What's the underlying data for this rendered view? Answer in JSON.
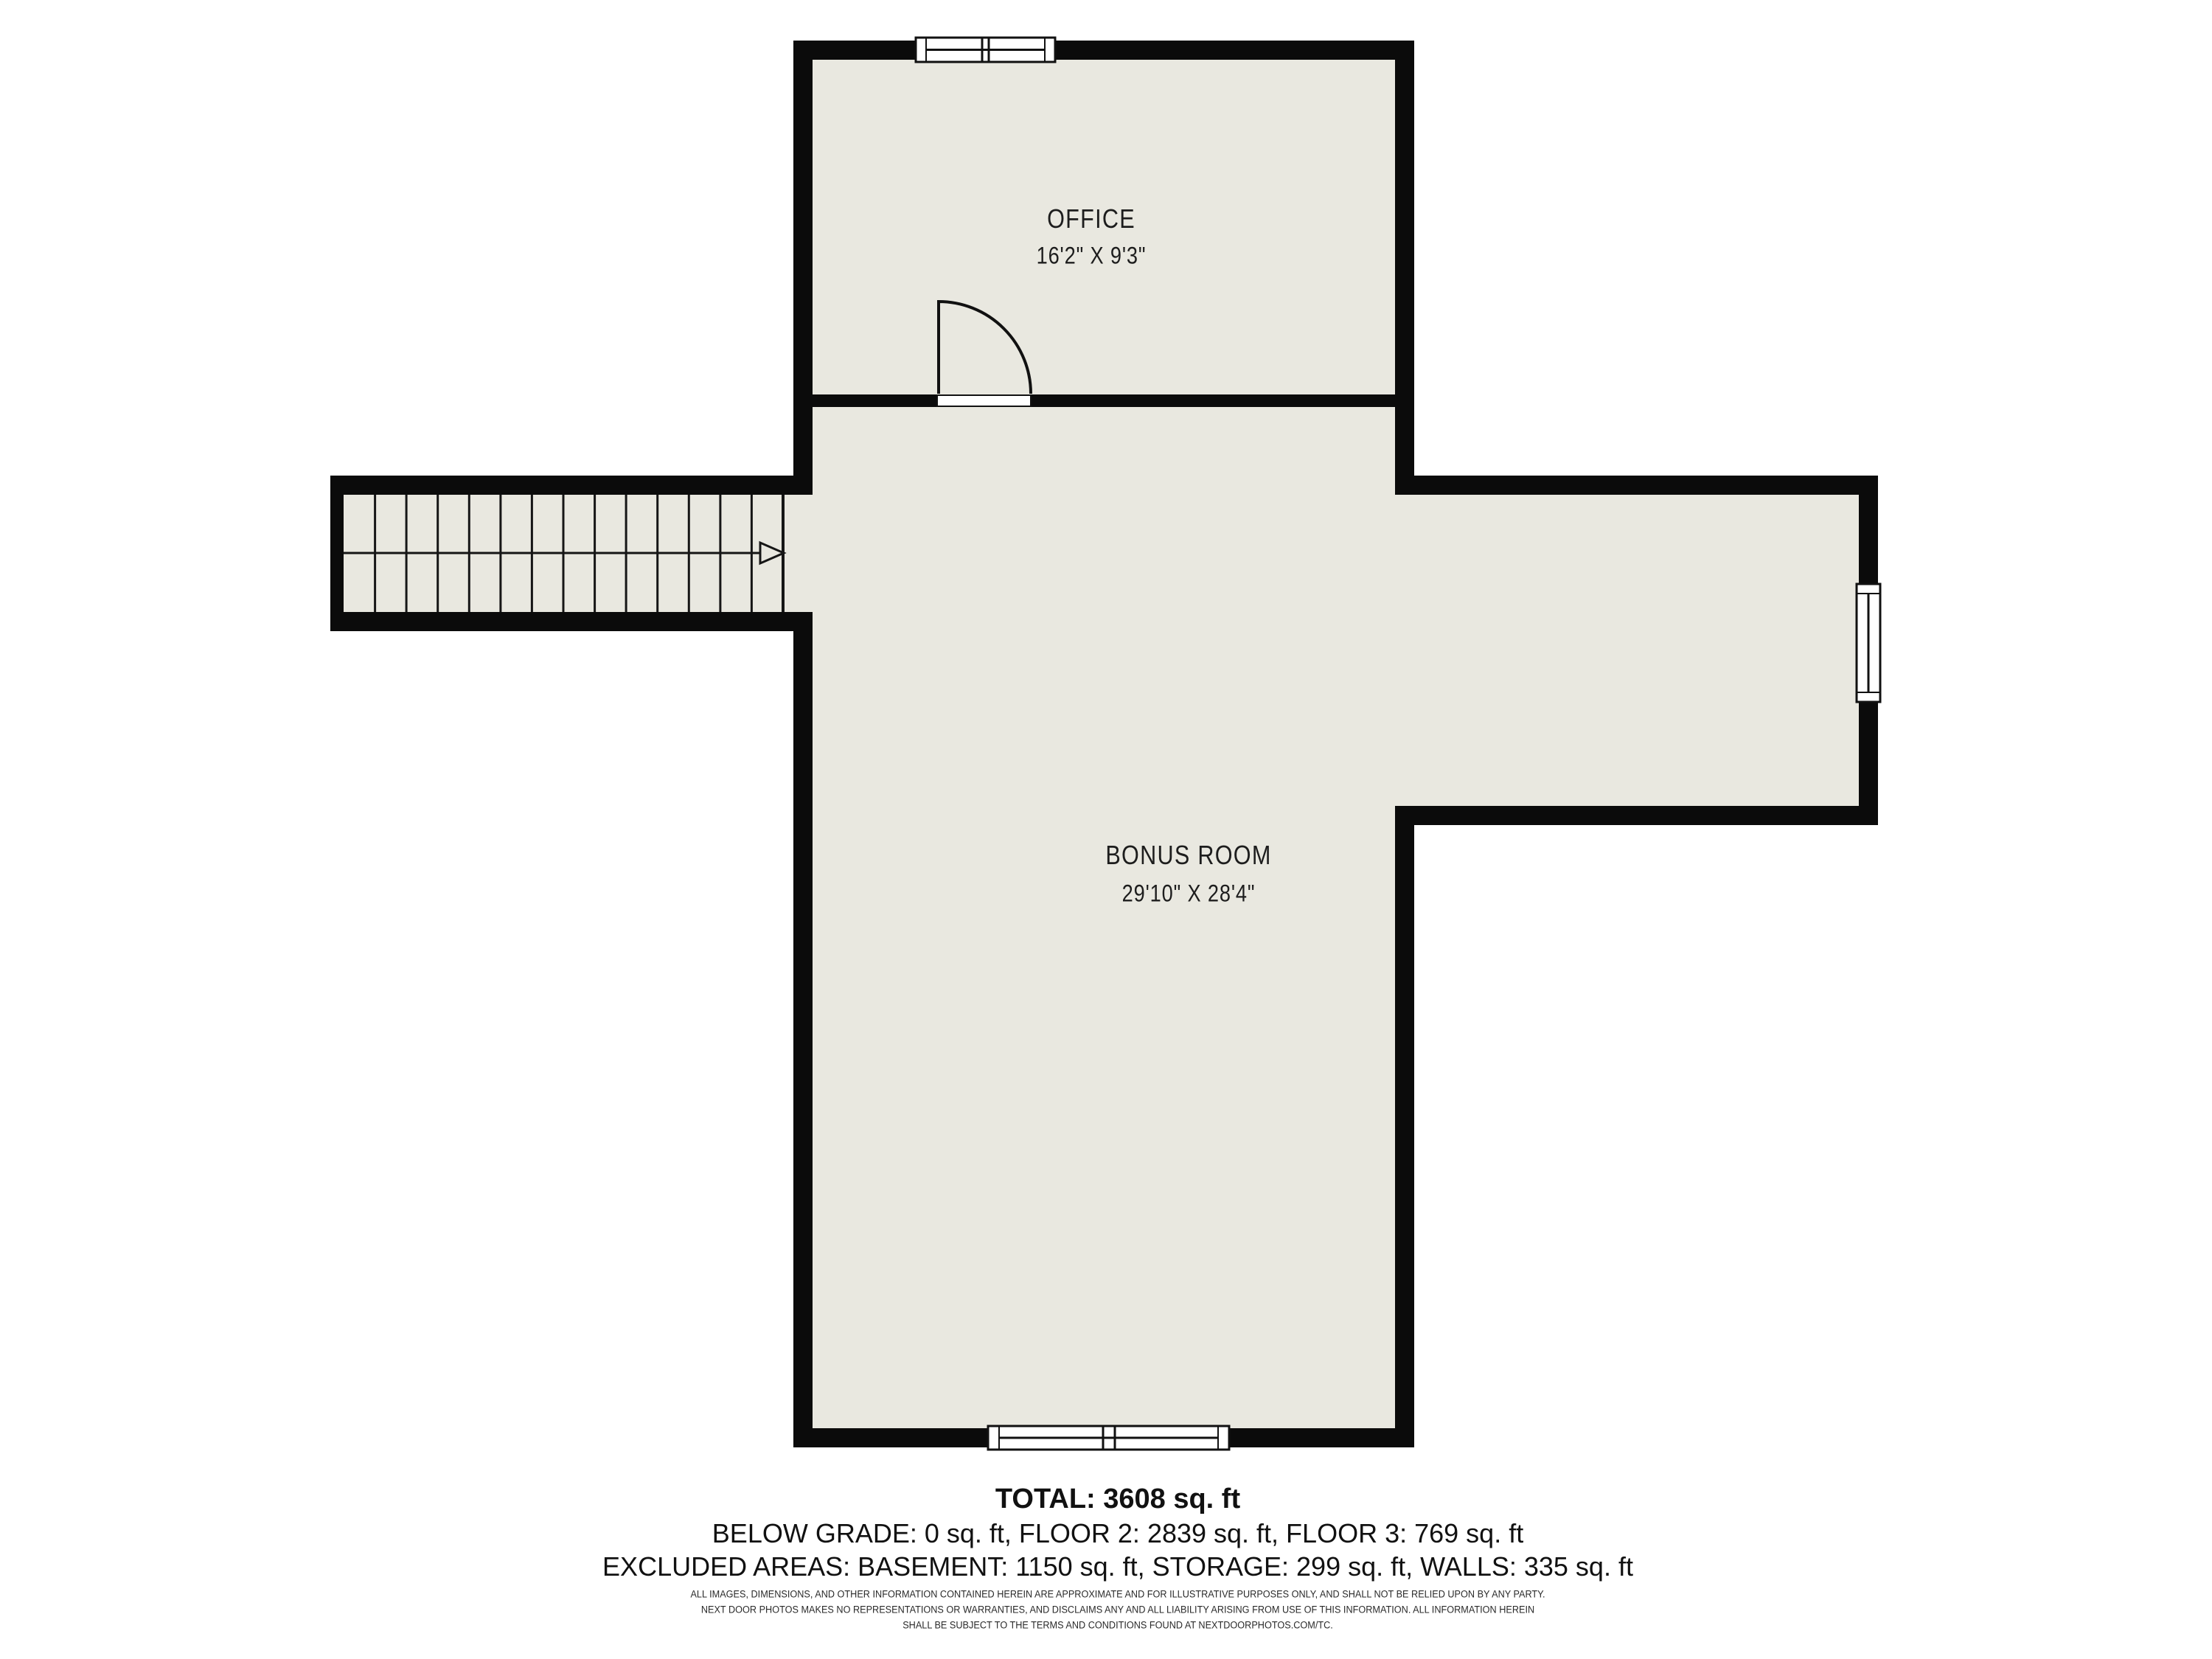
{
  "rooms": [
    {
      "name": "OFFICE",
      "dims": "16'2\" X 9'3\""
    },
    {
      "name": "BONUS ROOM",
      "dims": "29'10\" X 28'4\""
    }
  ],
  "summary": {
    "total": "TOTAL: 3608 sq. ft",
    "floors": "BELOW GRADE: 0 sq. ft, FLOOR 2: 2839 sq. ft, FLOOR 3: 769 sq. ft",
    "excluded": "EXCLUDED AREAS: BASEMENT: 1150 sq. ft, STORAGE: 299 sq. ft, WALLS: 335 sq. ft"
  },
  "disclaimer": {
    "line1": "ALL IMAGES, DIMENSIONS, AND OTHER INFORMATION CONTAINED HEREIN ARE APPROXIMATE AND FOR ILLUSTRATIVE PURPOSES ONLY, AND SHALL NOT BE RELIED UPON BY ANY PARTY.",
    "line2": "NEXT DOOR PHOTOS MAKES NO REPRESENTATIONS OR WARRANTIES, AND DISCLAIMS ANY AND ALL LIABILITY ARISING FROM USE OF THIS INFORMATION. ALL INFORMATION HEREIN",
    "line3": "SHALL BE SUBJECT TO THE TERMS AND CONDITIONS FOUND AT NEXTDOORPHOTOS.COM/TC."
  },
  "colors": {
    "wall": "#0b0b0b",
    "floor": "#e9e8e0",
    "background": "#ffffff",
    "text": "#1d1d1d"
  }
}
